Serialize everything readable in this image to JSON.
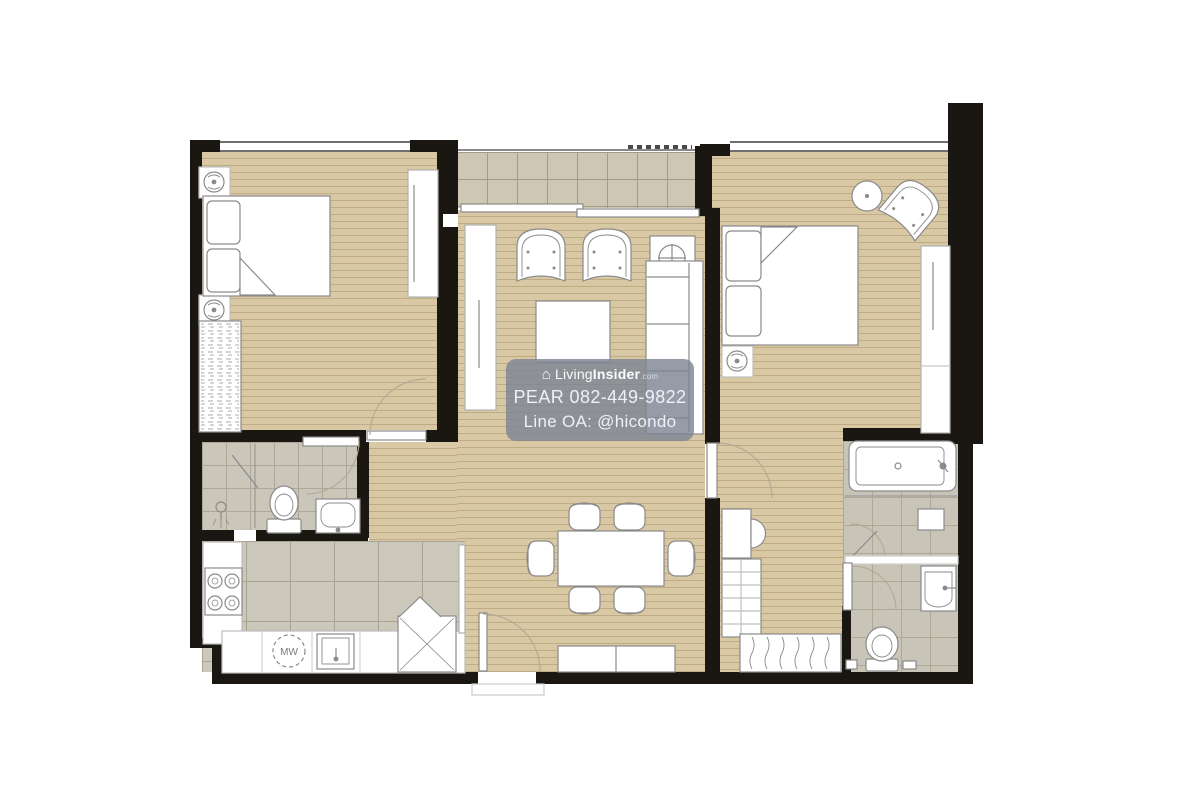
{
  "watermark": {
    "house_icon": "⌂",
    "brand_prefix": "Living",
    "brand_suffix": "Insider",
    "brand_tld": ".com",
    "phone_line": "PEAR 082-449-9822",
    "line_oa": "Line OA: @hicondo"
  },
  "kitchen": {
    "microwave_label": "MW"
  },
  "colors": {
    "wall": "#1a1713",
    "wood_floor": "#d9c8a4",
    "wood_stripe": "#b49a6b",
    "bathroom_tile": "#cbc6ba",
    "balcony_tile": "#cec7b3",
    "furniture_outline": "#8a8a8a",
    "door_arc": "#b3ab97",
    "watermark_bg": "#7a8392",
    "watermark_text": "#f2f4f7"
  }
}
